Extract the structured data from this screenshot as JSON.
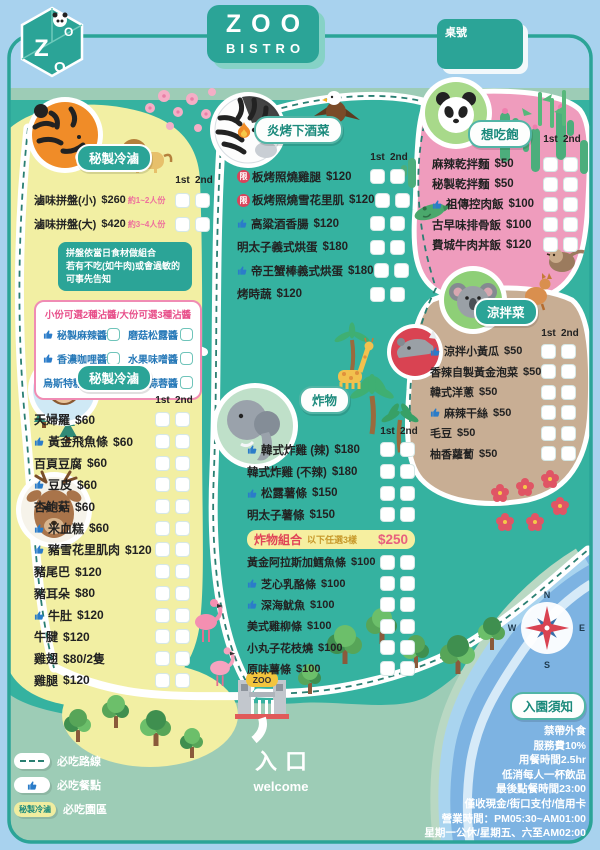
{
  "header": {
    "logo_letters": [
      "Z",
      "O",
      "O"
    ],
    "title_top": "ZOO",
    "title_bottom": "BISTRO",
    "table_label": "桌號"
  },
  "columns": {
    "first": "1st",
    "second": "2nd"
  },
  "sections": {
    "luwei_platter": {
      "badge": "秘製冷滷",
      "items": [
        {
          "name": "滷味拼盤(小)",
          "price": "$260",
          "note": "約1~2人份"
        },
        {
          "name": "滷味拼盤(大)",
          "price": "$420",
          "note": "約3~4人份"
        }
      ],
      "notice_lines": [
        "拼盤依當日食材做組合",
        "若有不吃(如牛肉)或會過敏的",
        "可事先告知"
      ],
      "sauce_title": "小份可選2種沾醬/大份可選3種沾醬",
      "sauces": [
        {
          "name": "秘製麻辣醬",
          "thumb": true
        },
        {
          "name": "磨菇松露醬"
        },
        {
          "name": "香濃咖哩醬",
          "thumb": true
        },
        {
          "name": "水果味噌醬"
        },
        {
          "name": "烏斯特糖醋醬"
        },
        {
          "name": "特製蒜蓉醬"
        }
      ]
    },
    "luwei_items": {
      "badge": "秘製冷滷",
      "items": [
        {
          "name": "天婦羅",
          "price": "$60"
        },
        {
          "name": "黃金飛魚條",
          "price": "$60",
          "thumb": true
        },
        {
          "name": "百頁豆腐",
          "price": "$60"
        },
        {
          "name": "豆皮",
          "price": "$60",
          "thumb": true
        },
        {
          "name": "杏鮑菇",
          "price": "$60"
        },
        {
          "name": "米血糕",
          "price": "$60",
          "thumb": true
        },
        {
          "name": "豬雪花里肌肉",
          "price": "$120",
          "thumb": true
        },
        {
          "name": "豬尾巴",
          "price": "$120"
        },
        {
          "name": "豬耳朵",
          "price": "$80"
        },
        {
          "name": "牛肚",
          "price": "$120",
          "thumb": true
        },
        {
          "name": "牛腱",
          "price": "$120"
        },
        {
          "name": "雞翅",
          "price": "$80/2隻"
        },
        {
          "name": "雞腿",
          "price": "$120"
        }
      ]
    },
    "grill": {
      "badge": "炎烤下酒菜",
      "items": [
        {
          "name": "板烤照燒雞腿",
          "price": "$120",
          "limited": true
        },
        {
          "name": "板烤照燒雪花里肌",
          "price": "$120",
          "limited": true
        },
        {
          "name": "高粱酒香腸",
          "price": "$120",
          "thumb": true
        },
        {
          "name": "明太子義式烘蛋",
          "price": "$180"
        },
        {
          "name": "帝王蟹棒義式烘蛋",
          "price": "$180",
          "thumb": true
        },
        {
          "name": "烤時蔬",
          "price": "$120"
        }
      ]
    },
    "fried": {
      "badge": "炸物",
      "items": [
        {
          "name": "韓式炸雞 (辣)",
          "price": "$180",
          "thumb": true
        },
        {
          "name": "韓式炸雞 (不辣)",
          "price": "$180"
        },
        {
          "name": "松露薯條",
          "price": "$150",
          "thumb": true
        },
        {
          "name": "明太子薯條",
          "price": "$150"
        }
      ],
      "combo": {
        "title": "炸物組合",
        "subtitle": "以下任選3樣",
        "price": "$250"
      },
      "combo_items": [
        {
          "name": "黃金阿拉斯加鱈魚條",
          "price": "$100"
        },
        {
          "name": "芝心乳酪條",
          "price": "$100",
          "thumb": true
        },
        {
          "name": "深海魷魚",
          "price": "$100",
          "thumb": true
        },
        {
          "name": "美式雞柳條",
          "price": "$100"
        },
        {
          "name": "小丸子花枝燒",
          "price": "$100"
        },
        {
          "name": "原味薯條",
          "price": "$100"
        }
      ]
    },
    "rice": {
      "badge": "想吃飽",
      "items": [
        {
          "name": "麻辣乾拌麵",
          "price": "$50"
        },
        {
          "name": "秘製乾拌麵",
          "price": "$50"
        },
        {
          "name": "祖傳控肉飯",
          "price": "$100",
          "thumb": true
        },
        {
          "name": "古早味排骨飯",
          "price": "$100"
        },
        {
          "name": "費城牛肉丼飯",
          "price": "$120"
        }
      ]
    },
    "cold": {
      "badge": "涼拌菜",
      "items": [
        {
          "name": "涼拌小黃瓜",
          "price": "$50",
          "thumb": true
        },
        {
          "name": "香辣自製黃金泡菜",
          "price": "$50"
        },
        {
          "name": "韓式洋蔥",
          "price": "$50"
        },
        {
          "name": "麻辣干絲",
          "price": "$50",
          "thumb": true
        },
        {
          "name": "毛豆",
          "price": "$50"
        },
        {
          "name": "柚香蘿蔔",
          "price": "$50"
        }
      ]
    },
    "notice": {
      "badge": "入園須知",
      "lines": [
        "禁帶外食",
        "服務費10%",
        "用餐時間2.5hr",
        "低消每人一杯飲品",
        "最後點餐時間23:00",
        "僅收現金/街口支付/信用卡",
        "營業時間：PM05:30~AM01:00",
        "星期一公休/星期五、六至AM02:00"
      ]
    }
  },
  "legend": {
    "route_label": "必吃路線",
    "dish_label": "必吃餐點",
    "area_label": "必吃園區",
    "area_badge": "秘製冷滷"
  },
  "entrance": {
    "gate_sign": "ZOO",
    "label": "入口",
    "welcome": "welcome"
  },
  "compass": {
    "n": "N",
    "e": "E",
    "s": "S",
    "w": "W"
  },
  "icons": {
    "thumb": "thumbs-up",
    "limited_text": "限",
    "fire": "flame"
  },
  "colors": {
    "brand_teal": "#2ba497",
    "landmass": "#35b2a0",
    "yellow_area": "#f2efa3",
    "pink_area": "#ef9cbd",
    "tan_area": "#c8ae94",
    "water": "#7db3e2",
    "sky": "#a8d2ee",
    "accent_pink": "#e8618c",
    "thumb_blue": "#2b7cc9",
    "limited_red": "#d9435b",
    "banner_yellow": "#f6efa0"
  }
}
